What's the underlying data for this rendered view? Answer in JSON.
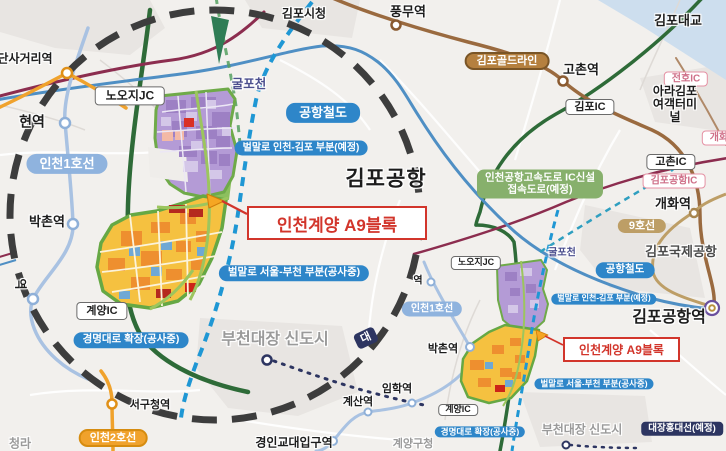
{
  "title": "인천계양 A9블록 위치도",
  "colors": {
    "background": "#f2f0ed",
    "water": "#cddeee",
    "magnifier_dash": "#3d3d3d",
    "expressway_green": "#2e6b38",
    "national_road_maroon": "#8c2d4f",
    "goldline_brown": "#9a6a3f",
    "line9_tan": "#bd9e66",
    "airport_rail_blue": "#4f8fc4",
    "incheon_line1_blue": "#a9c2e2",
    "incheon_line2_orange": "#f0a22c",
    "planned_road_dashed_blue": "#1f97d4",
    "daejang_hongdae_navy": "#2d3561",
    "callout_red": "#d2352b",
    "parcel_purple": "#b49bd6",
    "parcel_yellow": "#f5c140",
    "parcel_green_ring": "#66a844",
    "label_pill_blue": "#2e86c9",
    "label_box_green": "#87b06c"
  },
  "labels": {
    "gimpo_sicheong": "김포시청",
    "pungmu_station": "풍무역",
    "gimpo_bridge": "김포대교",
    "dansageori_station_partial": "단사거리역",
    "hyeon_station_partial": "현역",
    "yeok_partial_vertical": "역",
    "yeok_partial_mini": "역",
    "dae_partial": "대",
    "nooji_jc": "노오지JC",
    "gulpocheon": "굴포천",
    "airport_railroad": "공항철도",
    "beolmal_incheon_gimpo": "벌말로 인천-김포 부분(예정)",
    "gimpo_airport": "김포공항",
    "incheon_line1": "인천1호선",
    "callout_a9": "인천계양 A9블록",
    "bakchon_station": "박촌역",
    "beolmal_seoul_bucheon": "벌말로 서울-부천 부분(공사중)",
    "gyeyang_ic": "계양IC",
    "gyeongmyeong_expansion": "경명대로 확장(공사중)",
    "bucheon_daejang_newtown": "부천대장 신도시",
    "seogucheong_station": "서구청역",
    "incheon_line2": "인천2호선",
    "cheongna_partial": "청라",
    "gimpo_goldline": "김포골드라인",
    "gochon_station": "고촌역",
    "gimpo_ic": "김포IC",
    "jeonho_ic": "전호IC",
    "ara_gimpo_terminal": "아라김포\n여객터미널",
    "gaehwa_ic_partial": "개화IC",
    "gochon_ic": "고촌IC",
    "gimpo_airport_ic": "김포공항IC",
    "gaehwa_station": "개화역",
    "line9": "9호선",
    "gimpo_intl_airport": "김포국제공항",
    "access_road_planned": "인천공항고속도로 IC신설\n접속도로(예정)",
    "gimpo_airport_station": "김포공항역",
    "imhak_station": "임학역",
    "gyesan_station": "계산역",
    "gyeongin_edu_station": "경인교대입구역",
    "gyeyang_gucheong": "계양구청",
    "daejang_hongdae_line": "대장홍대선(예정)"
  }
}
